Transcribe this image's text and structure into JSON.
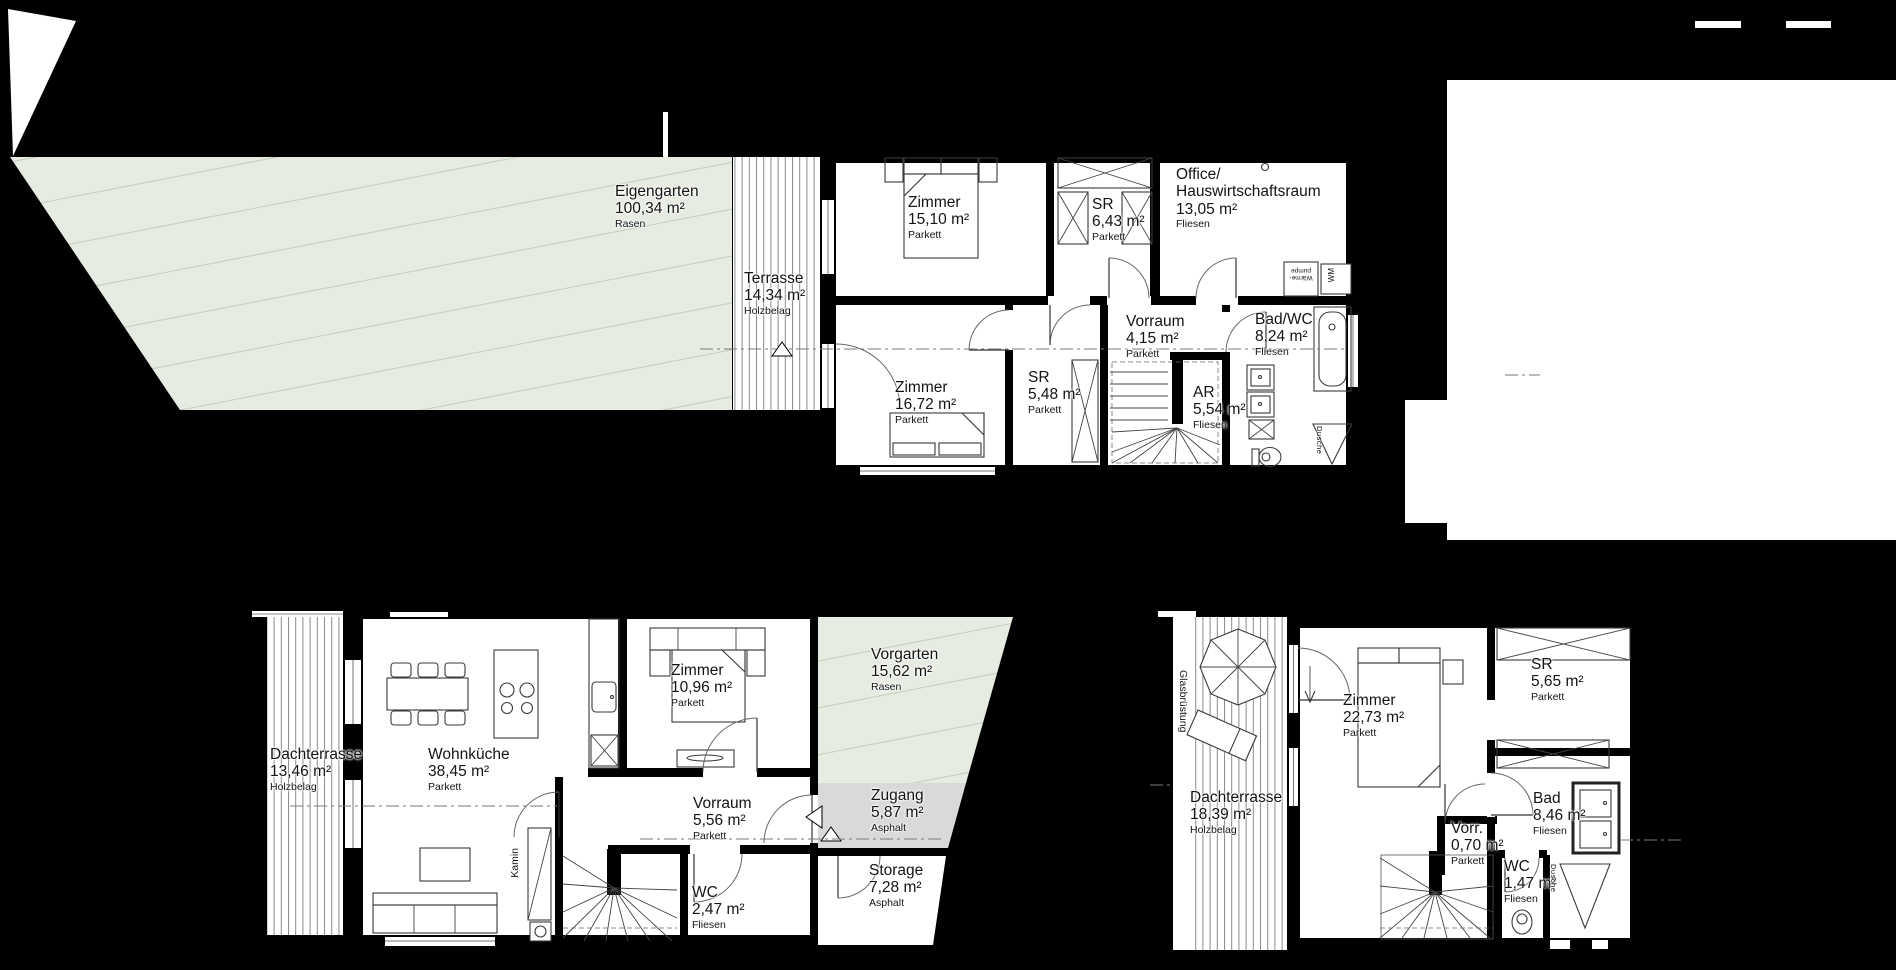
{
  "page": {
    "background": "#000000",
    "paper": "#ffffff",
    "lawn_color": "#e7ece3",
    "lawn_hatch": "#c2cdbc",
    "asphalt_color": "#d9d9d9",
    "deck_line": "#8a8a8a"
  },
  "labels": {
    "eigengarten": {
      "name": "Eigengarten",
      "area": "100,34 m²",
      "surface": "Rasen"
    },
    "terrasse": {
      "name": "Terrasse",
      "area": "14,34 m²",
      "surface": "Holzbelag"
    },
    "zimmer_og1": {
      "name": "Zimmer",
      "area": "15,10 m²",
      "surface": "Parkett"
    },
    "sr_og1": {
      "name": "SR",
      "area": "6,43 m²",
      "surface": "Parkett"
    },
    "office": {
      "name": "Office/",
      "name2": "Hauswirtschaftsraum",
      "area": "13,05 m²",
      "surface": "Fliesen"
    },
    "vorraum_og": {
      "name": "Vorraum",
      "area": "4,15 m²",
      "surface": "Parkett"
    },
    "badwc": {
      "name": "Bad/WC",
      "area": "8,24 m²",
      "surface": "Fliesen"
    },
    "zimmer_og2": {
      "name": "Zimmer",
      "area": "16,72 m²",
      "surface": "Parkett"
    },
    "sr_og2": {
      "name": "SR",
      "area": "5,48 m²",
      "surface": "Parkett"
    },
    "ar": {
      "name": "AR",
      "area": "5,54 m²",
      "surface": "Fliesen"
    },
    "dachterrasse_a": {
      "name": "Dachterrasse",
      "area": "13,46 m²",
      "surface": "Holzbelag"
    },
    "wohnkueche": {
      "name": "Wohnküche",
      "area": "38,45 m²",
      "surface": "Parkett"
    },
    "zimmer_dg1": {
      "name": "Zimmer",
      "area": "10,96 m²",
      "surface": "Parkett"
    },
    "vorraum_dg": {
      "name": "Vorraum",
      "area": "5,56 m²",
      "surface": "Parkett"
    },
    "wc_dg": {
      "name": "WC",
      "area": "2,47 m²",
      "surface": "Fliesen"
    },
    "vorgarten": {
      "name": "Vorgarten",
      "area": "15,62 m²",
      "surface": "Rasen"
    },
    "zugang": {
      "name": "Zugang",
      "area": "5,87 m²",
      "surface": "Asphalt"
    },
    "storage": {
      "name": "Storage",
      "area": "7,28 m²",
      "surface": "Asphalt"
    },
    "dachterrasse_b": {
      "name": "Dachterrasse",
      "area": "18,39 m²",
      "surface": "Holzbelag"
    },
    "zimmer_dg2": {
      "name": "Zimmer",
      "area": "22,73 m²",
      "surface": "Parkett"
    },
    "sr_dg": {
      "name": "SR",
      "area": "5,65 m²",
      "surface": "Parkett"
    },
    "bad_dg": {
      "name": "Bad",
      "area": "8,46 m²",
      "surface": "Fliesen"
    },
    "vorr_dg": {
      "name": "Vorr.",
      "area": "0,70 m²",
      "surface": "Parkett"
    },
    "wc2_dg": {
      "name": "WC",
      "area": "1,47 m²",
      "surface": "Fliesen"
    }
  },
  "annotations": {
    "kamin": "Kamin",
    "glasbruestung": "Glasbrüstung",
    "dusche_og": "Dusche",
    "dusche_dg": "Dusche",
    "waermepumpe_l1": "Wärme-",
    "waermepumpe_l2": "pumpe",
    "wm": "WM"
  }
}
